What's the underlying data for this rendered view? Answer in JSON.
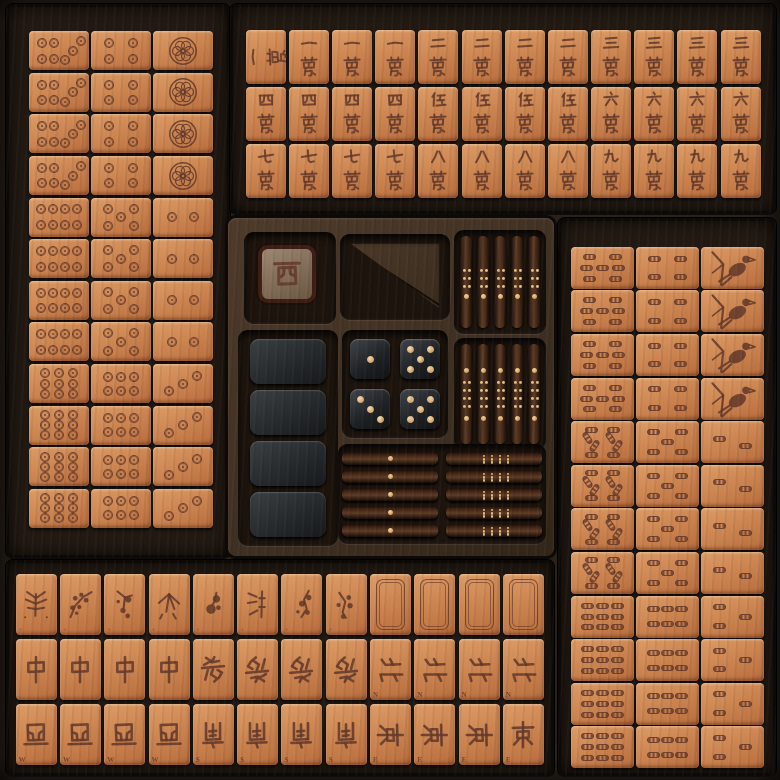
{
  "scene": "wooden mahjong set box with four tile trays and a center accessory tray",
  "colors": {
    "tile_leather": "#cd8652",
    "tile_highlight": "#dd9c66",
    "engraving": "#643a2a",
    "box_wood": "#2a211a",
    "tray_wood": "#231a13",
    "center_wood": "#4e3b2b",
    "recess": "#1d140d",
    "die_body": "#202326",
    "die_pip": "#e8c998",
    "stick_wood": "#5e3c27",
    "stick_dot": "#e5c28a",
    "blank_tile": "#24282b"
  },
  "suits": {
    "circles": {
      "tray": "left",
      "column_values": [
        [
          7,
          8,
          9
        ],
        [
          4,
          5,
          6
        ],
        [
          1,
          2,
          3
        ]
      ],
      "copies_per_value": 4
    },
    "characters": {
      "tray": "top",
      "row_values": [
        [
          "一",
          "二",
          "三"
        ],
        [
          "四",
          "伍",
          "六"
        ],
        [
          "七",
          "八",
          "九"
        ]
      ],
      "suffix": "萬",
      "copies_per_value": 4,
      "first_tile_rotated": true
    },
    "bamboos": {
      "tray": "right",
      "column_values": [
        [
          7,
          8,
          9
        ],
        [
          4,
          5,
          6
        ],
        [
          1,
          2,
          3
        ]
      ],
      "copies_per_value": 4,
      "one_is_bird": true
    }
  },
  "bottom_tray": {
    "row1_flowers": [
      "fern",
      "berry-branch",
      "hanging-buds",
      "bamboo-leaves",
      "peony",
      "bamboo-stalk",
      "plum-branch",
      "blossom-sprig"
    ],
    "row1_white_dragons": 4,
    "row2": [
      {
        "char": "中",
        "count": 4,
        "letter": "",
        "rots": [
          0,
          0,
          0,
          0
        ]
      },
      {
        "char": "發",
        "count": 4,
        "letter": "",
        "rots": [
          0,
          180,
          180,
          180
        ]
      },
      {
        "char": "北",
        "count": 4,
        "letter": "N",
        "rots": [
          90,
          90,
          90,
          90
        ]
      }
    ],
    "row3": [
      {
        "char": "西",
        "count": 4,
        "letter": "W",
        "rots": [
          180,
          180,
          180,
          180
        ]
      },
      {
        "char": "南",
        "count": 4,
        "letter": "S",
        "rots": [
          180,
          180,
          180,
          180
        ]
      },
      {
        "char": "東",
        "count": 4,
        "letter": "E",
        "rots": [
          90,
          90,
          90,
          0
        ]
      }
    ]
  },
  "center_tray": {
    "dealer_marker_char": "西",
    "dice_values": [
      1,
      5,
      3,
      5
    ],
    "blank_spare_tiles": 4,
    "score_sticks": {
      "vertical_top_count": 5,
      "vertical_bottom_count": 5,
      "horizontal_left_count": 5,
      "horizontal_right_count": 5,
      "horizontal_left_dots": 1,
      "horizontal_right_dots": 12
    }
  }
}
